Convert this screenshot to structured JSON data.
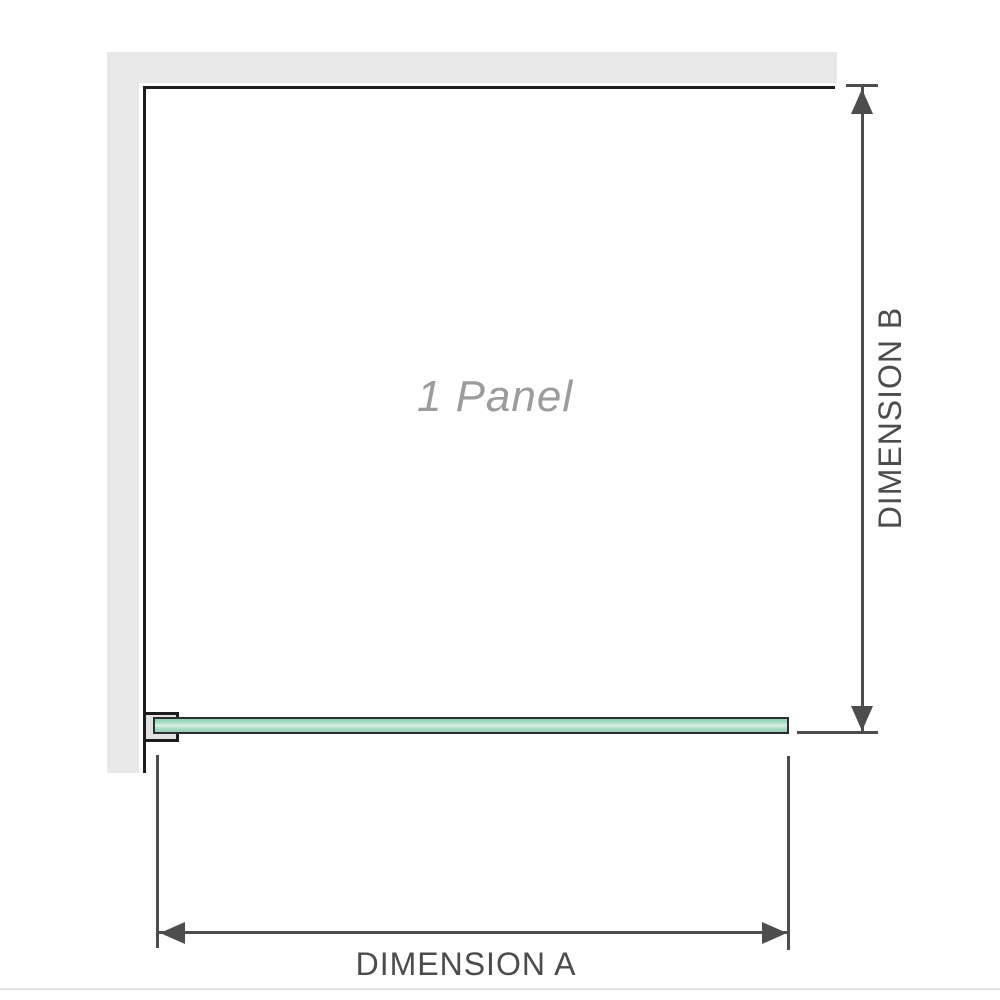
{
  "diagram": {
    "panel_label": "1 Panel",
    "dimension_a_label": "DIMENSION A",
    "dimension_b_label": "DIMENSION B",
    "colors": {
      "wall_gray": "#e9e9e9",
      "enclosure_outline": "#1c1c1c",
      "dimension_line": "#4d4d4d",
      "dimension_text": "#4c4c4c",
      "panel_label_gray": "#9c9c9c",
      "glass_green": "#9ed8bc",
      "glass_highlight": "#ddf0e6",
      "bottom_divider": "#e2e2dd"
    }
  }
}
